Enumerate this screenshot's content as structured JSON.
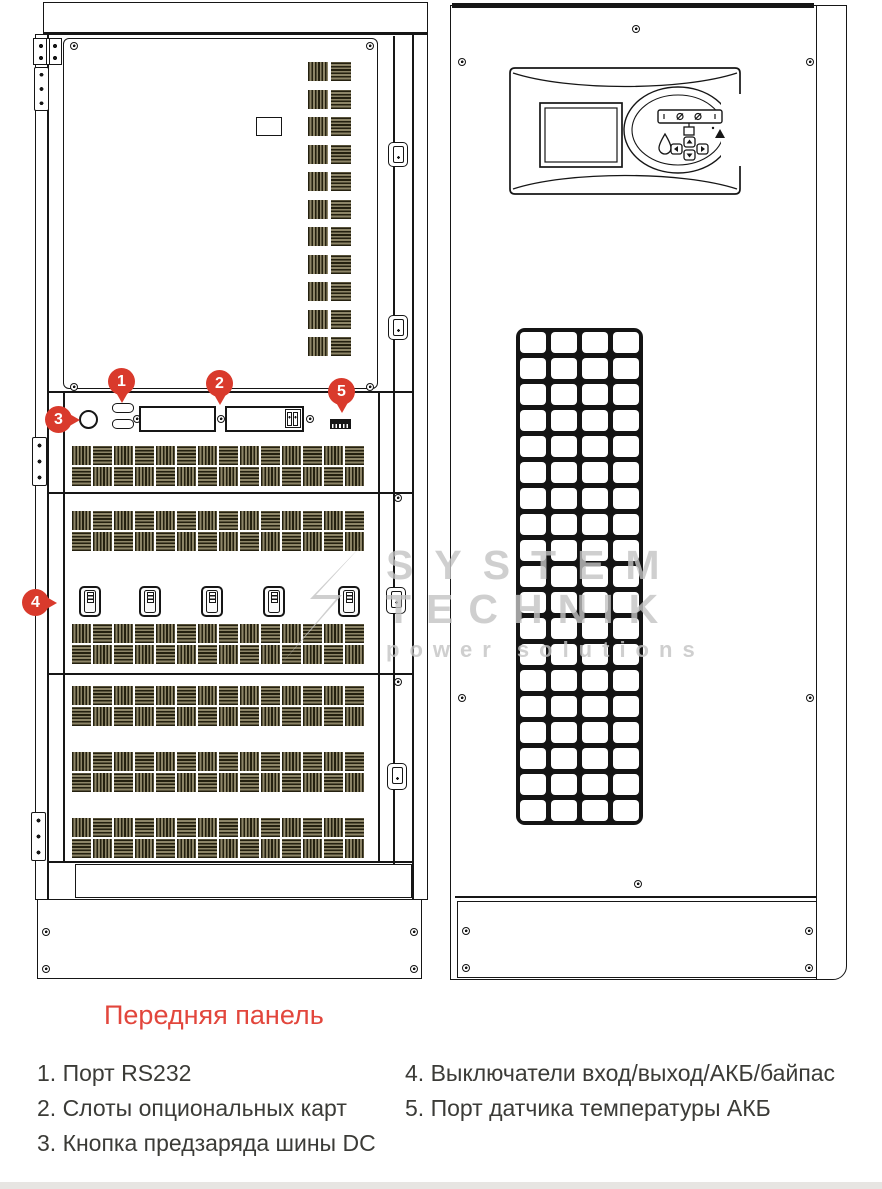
{
  "title": "Передняя панель",
  "callouts": [
    {
      "num": "1",
      "label": "Порт RS232"
    },
    {
      "num": "2",
      "label": "Слоты опциональных карт"
    },
    {
      "num": "3",
      "label": "Кнопка предзаряда шины DC"
    },
    {
      "num": "4",
      "label": "Выключатели вход/выход/АКБ/байпас"
    },
    {
      "num": "5",
      "label": "Порт датчика температуры АКБ"
    }
  ],
  "legend": {
    "col1": [
      "1. Порт RS232",
      "2. Слоты опциональных карт",
      "3. Кнопка предзаряда шины DC"
    ],
    "col2": [
      "4. Выключатели вход/выход/АКБ/байпас",
      "5. Порт датчика температуры АКБ"
    ]
  },
  "watermark": {
    "line1": "SYSTEM",
    "line2": "TECHNIK",
    "tagline": "power solutions"
  },
  "colors": {
    "callout_red": "#d93a2c",
    "title_red": "#e2463c",
    "line_black": "#161616",
    "vent_dark": "#24200f",
    "vent_light": "#8d8567",
    "watermark_gray": "#c3c3c3",
    "footer_gray": "#e7e5e2"
  }
}
